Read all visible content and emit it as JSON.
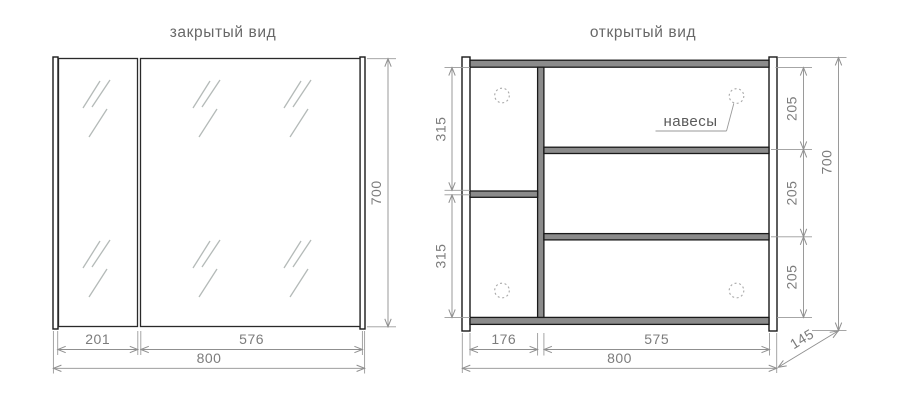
{
  "titles": {
    "closed_view": "закрытый вид",
    "open_view": "открытый вид"
  },
  "closed_view": {
    "door_left_width": "201",
    "door_right_width": "576",
    "total_width": "800",
    "height": "700"
  },
  "open_view": {
    "hinges_label": "навесы",
    "left_section_top_height": "315",
    "left_section_bottom_height": "315",
    "right_gap_top": "205",
    "right_gap_middle": "205",
    "right_gap_bottom": "205",
    "height": "700",
    "left_section_width": "176",
    "right_section_width": "575",
    "total_width": "800",
    "depth": "145"
  },
  "icons": {
    "hinge_hole": "dotted-circle"
  },
  "colors": {
    "panel_fill": "#8b8b8b",
    "outline": "#1a1a1a",
    "dimension_lines": "#8f8f8f",
    "dimension_text": "#7c7c7c",
    "mirror_hatch": "#b4bab8",
    "background": "#ffffff"
  }
}
